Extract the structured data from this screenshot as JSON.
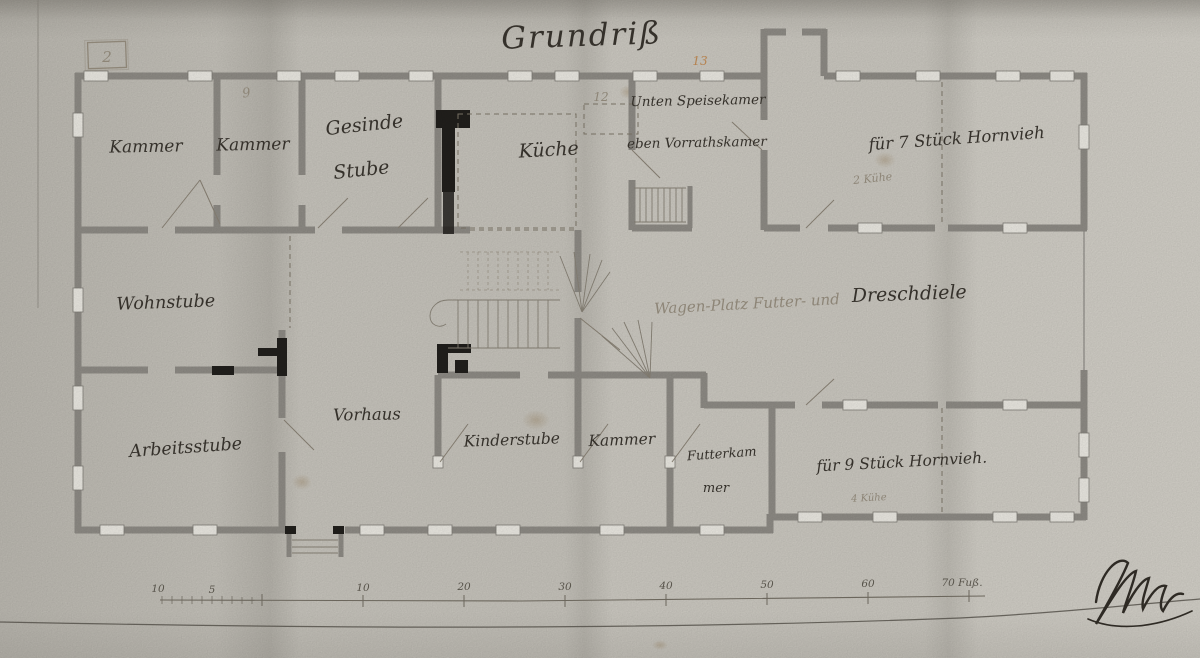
{
  "palette": {
    "paper": "#cac7bf",
    "ink": "#35312b",
    "wall_gray": "#918e88",
    "pencil": "#8d8577",
    "pencil_orange": "#b5824f"
  },
  "title": {
    "text": "Grundriß"
  },
  "rooms": {
    "kammer_nw": {
      "label": "Kammer"
    },
    "kammer_n": {
      "label": "Kammer"
    },
    "gesinde_stube": {
      "line1": "Gesinde",
      "line2": "Stube"
    },
    "kueche": {
      "label": "Küche"
    },
    "speisekammer": {
      "line1": "Unten Speisekamer",
      "line2": "eben Vorrathskamer"
    },
    "stall_nord": {
      "label": "für 7 Stück Hornvieh",
      "pencil_note": "2 Kühe"
    },
    "wohnstube": {
      "label": "Wohnstube"
    },
    "diele": {
      "pencil_part": "Wagen-Platz Futter- und",
      "ink_part": "Dreschdiele"
    },
    "arbeitsstube": {
      "label": "Arbeitsstube"
    },
    "vorhaus": {
      "label": "Vorhaus"
    },
    "kinderstube": {
      "label": "Kinderstube"
    },
    "kammer_s": {
      "label": "Kammer"
    },
    "futterkammer": {
      "line1": "Futterkam",
      "line2": "mer"
    },
    "stall_sued": {
      "label": "für 9 Stück Hornvieh.",
      "pencil_note": "4 Kühe"
    }
  },
  "pencil_annotations": {
    "boxed_number": "2",
    "number_9": "9",
    "number_12": "12",
    "number_13": "13"
  },
  "scale_bar": {
    "left_labels": [
      "10",
      "5"
    ],
    "major_labels": [
      "10",
      "20",
      "30",
      "40",
      "50",
      "60"
    ],
    "end_label": "70 Fuß."
  }
}
